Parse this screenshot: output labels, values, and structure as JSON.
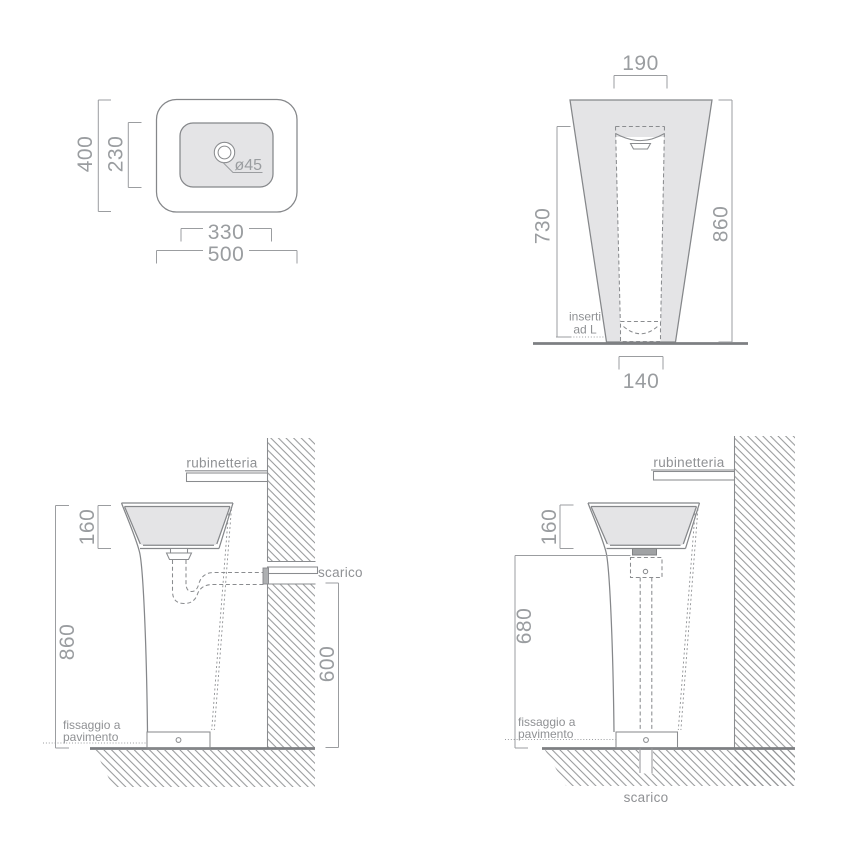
{
  "views": {
    "plan": {
      "depth": "400",
      "inner_depth": "230",
      "inner_width": "330",
      "width": "500",
      "drain_diameter": "ø45"
    },
    "front": {
      "top_width": "190",
      "insert_height": "730",
      "height": "860",
      "base_width": "140",
      "insert_label_line1": "inserti",
      "insert_label_line2": "ad L"
    },
    "side_wall_drain": {
      "rim_height": "160",
      "height": "860",
      "drain_height": "600",
      "tap_label": "rubinetteria",
      "drain_label": "scarico",
      "fixing_label_line1": "fissaggio a",
      "fixing_label_line2": "pavimento"
    },
    "side_floor_drain": {
      "rim_height": "160",
      "clearance_height": "680",
      "tap_label": "rubinetteria",
      "drain_label": "scarico",
      "fixing_label_line1": "fissaggio a",
      "fixing_label_line2": "pavimento"
    }
  },
  "colors": {
    "body_fill": "#e4e4e6",
    "outline": "#85878a",
    "dimension": "#9b9da0",
    "text": "#8f9194",
    "floor": "#7d7f82"
  }
}
